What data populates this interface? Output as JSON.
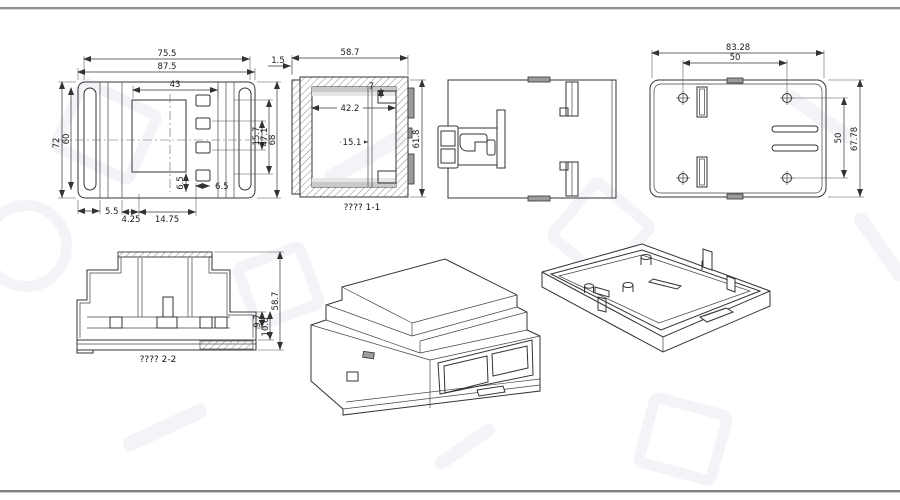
{
  "drawing": {
    "front": {
      "w_top": "75.5",
      "w_outer": "87.5",
      "w_inner": "43",
      "h_outer": "72",
      "h_inner": "60",
      "r_outer": "68",
      "r_mid": "47.1",
      "r_inner": "15.7",
      "b_left": "5.5",
      "b_a": "4.25",
      "b_b": "14.75",
      "s_a": "6.5",
      "s_b": "6.5"
    },
    "section1": {
      "caption": "???? 1-1",
      "top": "58.7",
      "lip": "1.5",
      "inner": "42.2",
      "pocket": "15.1",
      "tab": "7",
      "height": "61.8"
    },
    "plate": {
      "w": "83.28",
      "wx": "50",
      "hy": "50",
      "h": "67.78"
    },
    "section2": {
      "caption": "???? 2-2",
      "a": "9.7",
      "b": "10.6",
      "h": "58.7"
    }
  }
}
